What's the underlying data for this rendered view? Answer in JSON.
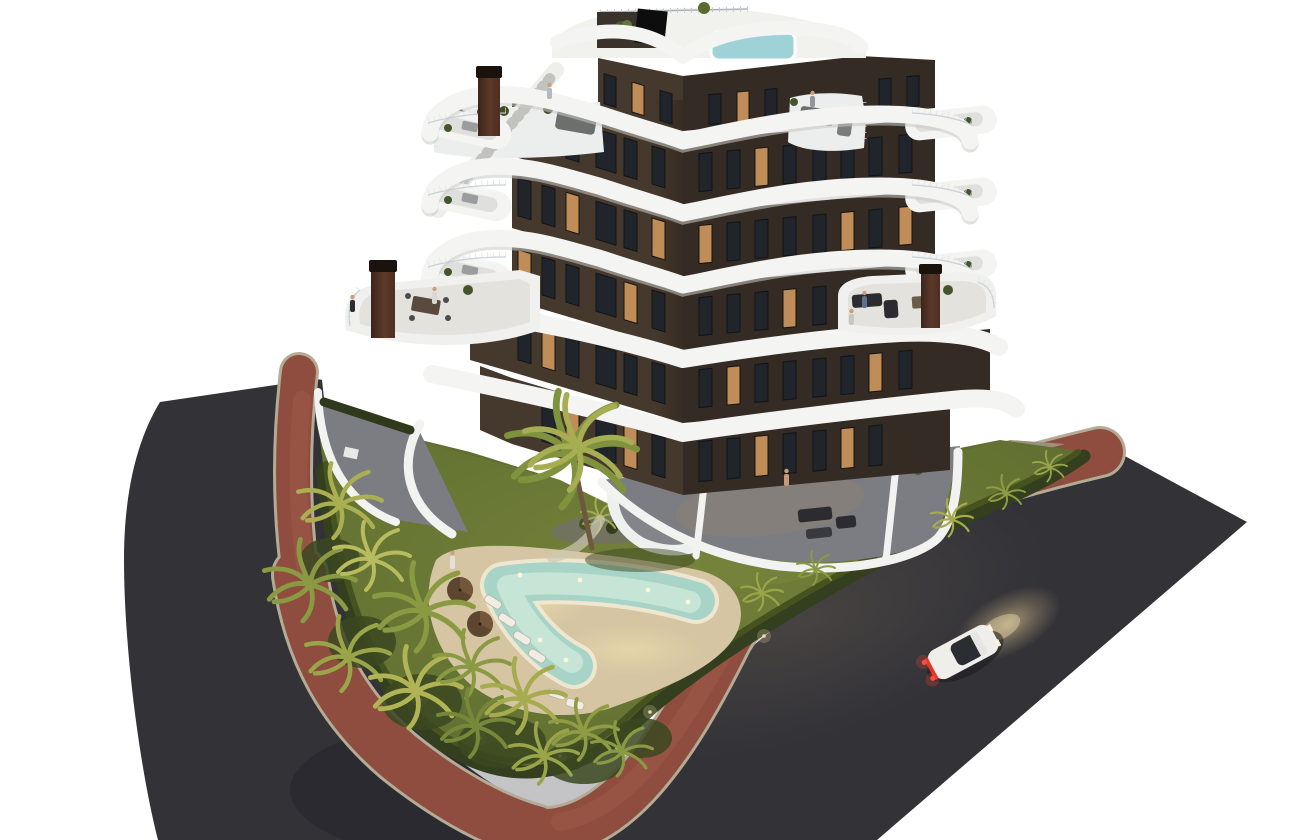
{
  "scene": {
    "type": "aerial architectural 3d render",
    "description": "Dusk aerial view of a modern V-shaped apartment building with white curved wrap-around balconies, landscaped garden with freeform pool and palm trees, terracotta sidewalk and two dark asphalt streets meeting at a corner, single white car driving on the right street, isolated on a white background",
    "background": "white",
    "time_of_day": "dusk, interior lights on"
  },
  "colors": {
    "background": "#ffffff",
    "asphalt": "#323237",
    "curb": "#b3ab95",
    "sidewalk": "#8e4d3e",
    "lawn": "#5f6d30",
    "hedge": "#333f1f",
    "sand": "#d5c5a2",
    "pool_water": "#a7d4c6",
    "pool_rim": "#f0e8d2",
    "band_white": "#f4f4f2",
    "facade_left": "#45382c",
    "facade_right": "#332b24",
    "roof_white": "#f1f1ee",
    "rooftop_pool": "#9fd2d6",
    "terrace_floor": "#7c7d82",
    "chimney": "#4c2e22",
    "car_body": "#efeeea",
    "taillight": "#e23326",
    "headlight_glow": "#d8bd8a",
    "window_dark": "#20242b",
    "window_lit": "#c08d58",
    "palm_bright": "#b8bc5e",
    "palm_mid": "#8a9a43",
    "palm_dark": "#5a6c2c"
  },
  "building": {
    "shape": "V-shaped tower, corner toward viewer",
    "floors_visible": 7,
    "balconies": "continuous white curved ribbon balconies on every floor",
    "chimneys": 3,
    "rooftop": [
      "roof terrace",
      "plunge pool",
      "stair bulkhead",
      "planters"
    ],
    "ground_floor": "private terraces with white privacy walls and outdoor furniture"
  },
  "garden": {
    "pool_shape": "freeform boomerang lagoon with lights on",
    "sun_loungers": 6,
    "parasols": 2,
    "palm_trees": 18,
    "features": [
      "lawn",
      "perimeter hedge",
      "pebble planting island",
      "sand-colored pool deck",
      "path lights"
    ]
  },
  "streets": {
    "layout": "two asphalt roads meeting at a rounded corner around the plot",
    "sidewalk": "terracotta red paved strip with light curb"
  },
  "vehicle": {
    "count": 1,
    "type": "white car, headlights and brake lights on, driving on right-hand road"
  },
  "people_visible": 8
}
